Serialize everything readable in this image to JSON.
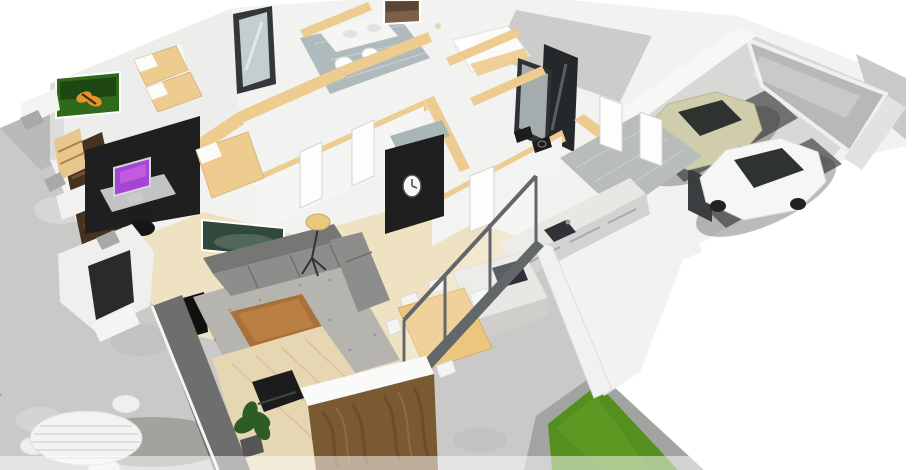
{
  "scene": {
    "description": "3D aerial cutaway floor-plan render of a modern single-story house with furnished rooms, double garage, concrete patio and small lawn",
    "rooms": [
      "kids-bedroom",
      "bathroom",
      "master-bedroom",
      "hallway",
      "garage",
      "home-office",
      "bedroom",
      "living-room",
      "wc-shower",
      "kitchen",
      "dining-area",
      "entry-courtyard",
      "patio",
      "lawn"
    ]
  },
  "colors": {
    "bg": "#ffffff",
    "wall": "#f2f2f1",
    "wallShade": "#e2e2e1",
    "capTan": "#eecb8e",
    "woodFloor": "#efe2c2",
    "woodDeck": "#e6d6b2",
    "rug": "#b6b4af",
    "sofa": "#8d8d8b",
    "sofaDark": "#767674",
    "coffeeWood": "#a9713a",
    "diningTan": "#ecc57f",
    "chairWhite": "#f4f4f2",
    "island": "#e9e7e3",
    "cooktop": "#2e3138",
    "counterFace": "#d2d2d0",
    "tileHall": "#b8bcbb",
    "tileBath": "#aebabc",
    "mirror": "#ccd6d8",
    "accentBlack": "#1f1f1f",
    "clockFace": "#f6f6f5",
    "screenPurple": "#a445d6",
    "deskGray": "#c2c3c4",
    "stairsWood": "#45331f",
    "shelfTan": "#e7c78e",
    "bedWhite": "#fafaf9",
    "porchDark": "#2a2a2a",
    "fenceGray": "#6e6e6c",
    "concrete": "#c9c9c7",
    "concreteShade": "#b4b4b2",
    "curb": "#a2a4a2",
    "grass": "#55901f",
    "grassLight": "#6ca827",
    "garageFloor": "#d8d8d6",
    "garageDoor": "#b6b9b7",
    "tireTrack": "#5f5f5d",
    "carBeige": "#cfcdab",
    "carWhite": "#f6f6f4",
    "carGlass": "#2e332f",
    "glassFrame": "#62686a",
    "butterflyGreen": "#2f6a1a",
    "butterflyOrange": "#e8932a",
    "forestGreen": "#31493a",
    "citySepia": "#7a6148",
    "lampShade": "#eac97c",
    "plantGreen": "#2e5d24",
    "cabinetWood": "#7a5a33",
    "cabinetWoodLight": "#97703f",
    "doorWhite": "#fdfdfc",
    "tableWhite": "#f3f3f1",
    "shadow": "#3c3c3a"
  }
}
